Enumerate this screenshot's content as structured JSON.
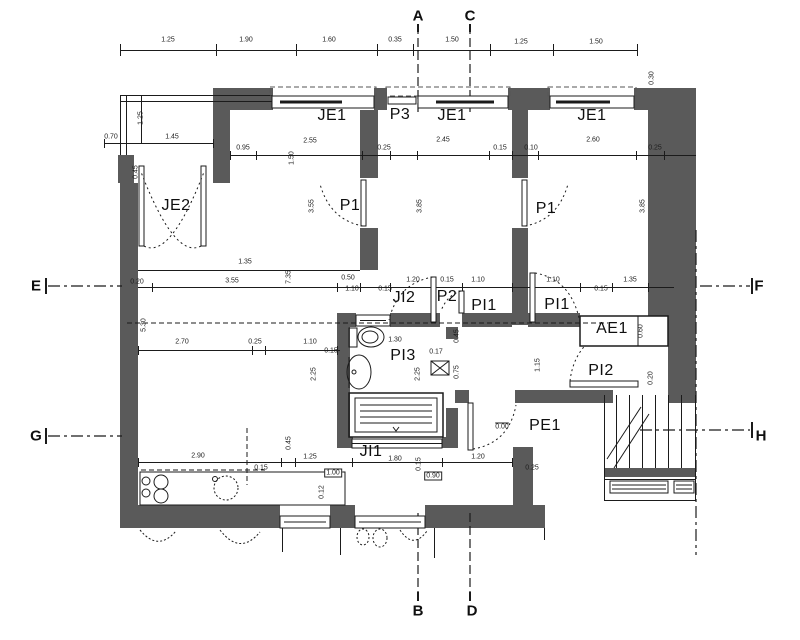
{
  "plan": {
    "title": "apartment floor plan",
    "room_labels": [
      {
        "t": "JE1",
        "x": 332,
        "y": 116
      },
      {
        "t": "P3",
        "x": 400,
        "y": 115
      },
      {
        "t": "JE1",
        "x": 452,
        "y": 116
      },
      {
        "t": "JE1",
        "x": 592,
        "y": 116
      },
      {
        "t": "JE2",
        "x": 176,
        "y": 206
      },
      {
        "t": "P1",
        "x": 350,
        "y": 206
      },
      {
        "t": "P1",
        "x": 546,
        "y": 209
      },
      {
        "t": "JI2",
        "x": 404,
        "y": 298
      },
      {
        "t": "P2",
        "x": 447,
        "y": 297
      },
      {
        "t": "PI1",
        "x": 484,
        "y": 306
      },
      {
        "t": "PI1",
        "x": 557,
        "y": 305
      },
      {
        "t": "AE1",
        "x": 612,
        "y": 329
      },
      {
        "t": "PI3",
        "x": 403,
        "y": 356
      },
      {
        "t": "PI2",
        "x": 601,
        "y": 371
      },
      {
        "t": "PE1",
        "x": 545,
        "y": 426
      },
      {
        "t": "JI1",
        "x": 371,
        "y": 452
      }
    ],
    "section_labels": [
      {
        "t": "A",
        "x": 418,
        "y": 16
      },
      {
        "t": "C",
        "x": 470,
        "y": 16
      },
      {
        "t": "B",
        "x": 418,
        "y": 611
      },
      {
        "t": "D",
        "x": 472,
        "y": 611
      },
      {
        "t": "E",
        "x": 36,
        "y": 286
      },
      {
        "t": "F",
        "x": 759,
        "y": 286
      },
      {
        "t": "G",
        "x": 36,
        "y": 436
      },
      {
        "t": "H",
        "x": 761,
        "y": 436
      }
    ],
    "dims_h": [
      {
        "t": "1.25",
        "x": 168,
        "y": 40
      },
      {
        "t": "1.90",
        "x": 246,
        "y": 40
      },
      {
        "t": "1.60",
        "x": 329,
        "y": 40
      },
      {
        "t": "0.35",
        "x": 395,
        "y": 40
      },
      {
        "t": "1.50",
        "x": 452,
        "y": 40
      },
      {
        "t": "1.25",
        "x": 521,
        "y": 42
      },
      {
        "t": "1.50",
        "x": 596,
        "y": 42
      },
      {
        "t": "0.70",
        "x": 111,
        "y": 137
      },
      {
        "t": "1.45",
        "x": 172,
        "y": 137
      },
      {
        "t": "0.95",
        "x": 243,
        "y": 148
      },
      {
        "t": "2.55",
        "x": 310,
        "y": 141
      },
      {
        "t": "0.25",
        "x": 384,
        "y": 148
      },
      {
        "t": "2.45",
        "x": 443,
        "y": 140
      },
      {
        "t": "0.15",
        "x": 500,
        "y": 148
      },
      {
        "t": "0.10",
        "x": 531,
        "y": 148
      },
      {
        "t": "2.60",
        "x": 593,
        "y": 140
      },
      {
        "t": "0.25",
        "x": 655,
        "y": 148
      },
      {
        "t": "1.35",
        "x": 245,
        "y": 262
      },
      {
        "t": "0.20",
        "x": 137,
        "y": 282
      },
      {
        "t": "3.55",
        "x": 232,
        "y": 281
      },
      {
        "t": "0.50",
        "x": 348,
        "y": 278
      },
      {
        "t": "1.10",
        "x": 352,
        "y": 289
      },
      {
        "t": "0.15",
        "x": 385,
        "y": 289
      },
      {
        "t": "1.20",
        "x": 413,
        "y": 280
      },
      {
        "t": "0.15",
        "x": 447,
        "y": 280
      },
      {
        "t": "1.10",
        "x": 478,
        "y": 280
      },
      {
        "t": "1.10",
        "x": 553,
        "y": 280
      },
      {
        "t": "0.15",
        "x": 601,
        "y": 289
      },
      {
        "t": "1.35",
        "x": 630,
        "y": 280
      },
      {
        "t": "2.70",
        "x": 182,
        "y": 342
      },
      {
        "t": "0.25",
        "x": 255,
        "y": 342
      },
      {
        "t": "1.10",
        "x": 310,
        "y": 342
      },
      {
        "t": "0.15",
        "x": 331,
        "y": 351
      },
      {
        "t": "1.30",
        "x": 395,
        "y": 340
      },
      {
        "t": "0.17",
        "x": 436,
        "y": 352
      },
      {
        "t": "2.90",
        "x": 198,
        "y": 456
      },
      {
        "t": "0.15",
        "x": 261,
        "y": 468
      },
      {
        "t": "1.25",
        "x": 310,
        "y": 457
      },
      {
        "t": "1.80",
        "x": 395,
        "y": 459
      },
      {
        "t": "1.20",
        "x": 478,
        "y": 457
      },
      {
        "t": "0.25",
        "x": 532,
        "y": 468
      },
      {
        "t": "1.00",
        "x": 333,
        "y": 473,
        "box": true
      },
      {
        "t": "0.90",
        "x": 433,
        "y": 476,
        "box": true
      },
      {
        "t": "0.00",
        "x": 502,
        "y": 427,
        "lvl": true
      }
    ],
    "dims_v": [
      {
        "t": "1.25",
        "x": 141,
        "y": 118
      },
      {
        "t": "0.45",
        "x": 136,
        "y": 172
      },
      {
        "t": "1.50",
        "x": 292,
        "y": 158
      },
      {
        "t": "3.55",
        "x": 312,
        "y": 206
      },
      {
        "t": "3.85",
        "x": 420,
        "y": 206
      },
      {
        "t": "3.85",
        "x": 643,
        "y": 206
      },
      {
        "t": "0.30",
        "x": 652,
        "y": 78
      },
      {
        "t": "5.30",
        "x": 144,
        "y": 325
      },
      {
        "t": "7.35",
        "x": 289,
        "y": 277
      },
      {
        "t": "2.25",
        "x": 314,
        "y": 374
      },
      {
        "t": "2.25",
        "x": 418,
        "y": 374
      },
      {
        "t": "0.45",
        "x": 457,
        "y": 336
      },
      {
        "t": "0.75",
        "x": 457,
        "y": 372
      },
      {
        "t": "1.15",
        "x": 538,
        "y": 365
      },
      {
        "t": "0.60",
        "x": 641,
        "y": 331
      },
      {
        "t": "0.20",
        "x": 651,
        "y": 378
      },
      {
        "t": "0.15",
        "x": 419,
        "y": 464
      },
      {
        "t": "0.12",
        "x": 322,
        "y": 492
      },
      {
        "t": "0.45",
        "x": 289,
        "y": 443
      }
    ],
    "colors": {
      "wall": "#5a5a5a",
      "line": "#1b1b1b",
      "background": "#ffffff"
    }
  }
}
